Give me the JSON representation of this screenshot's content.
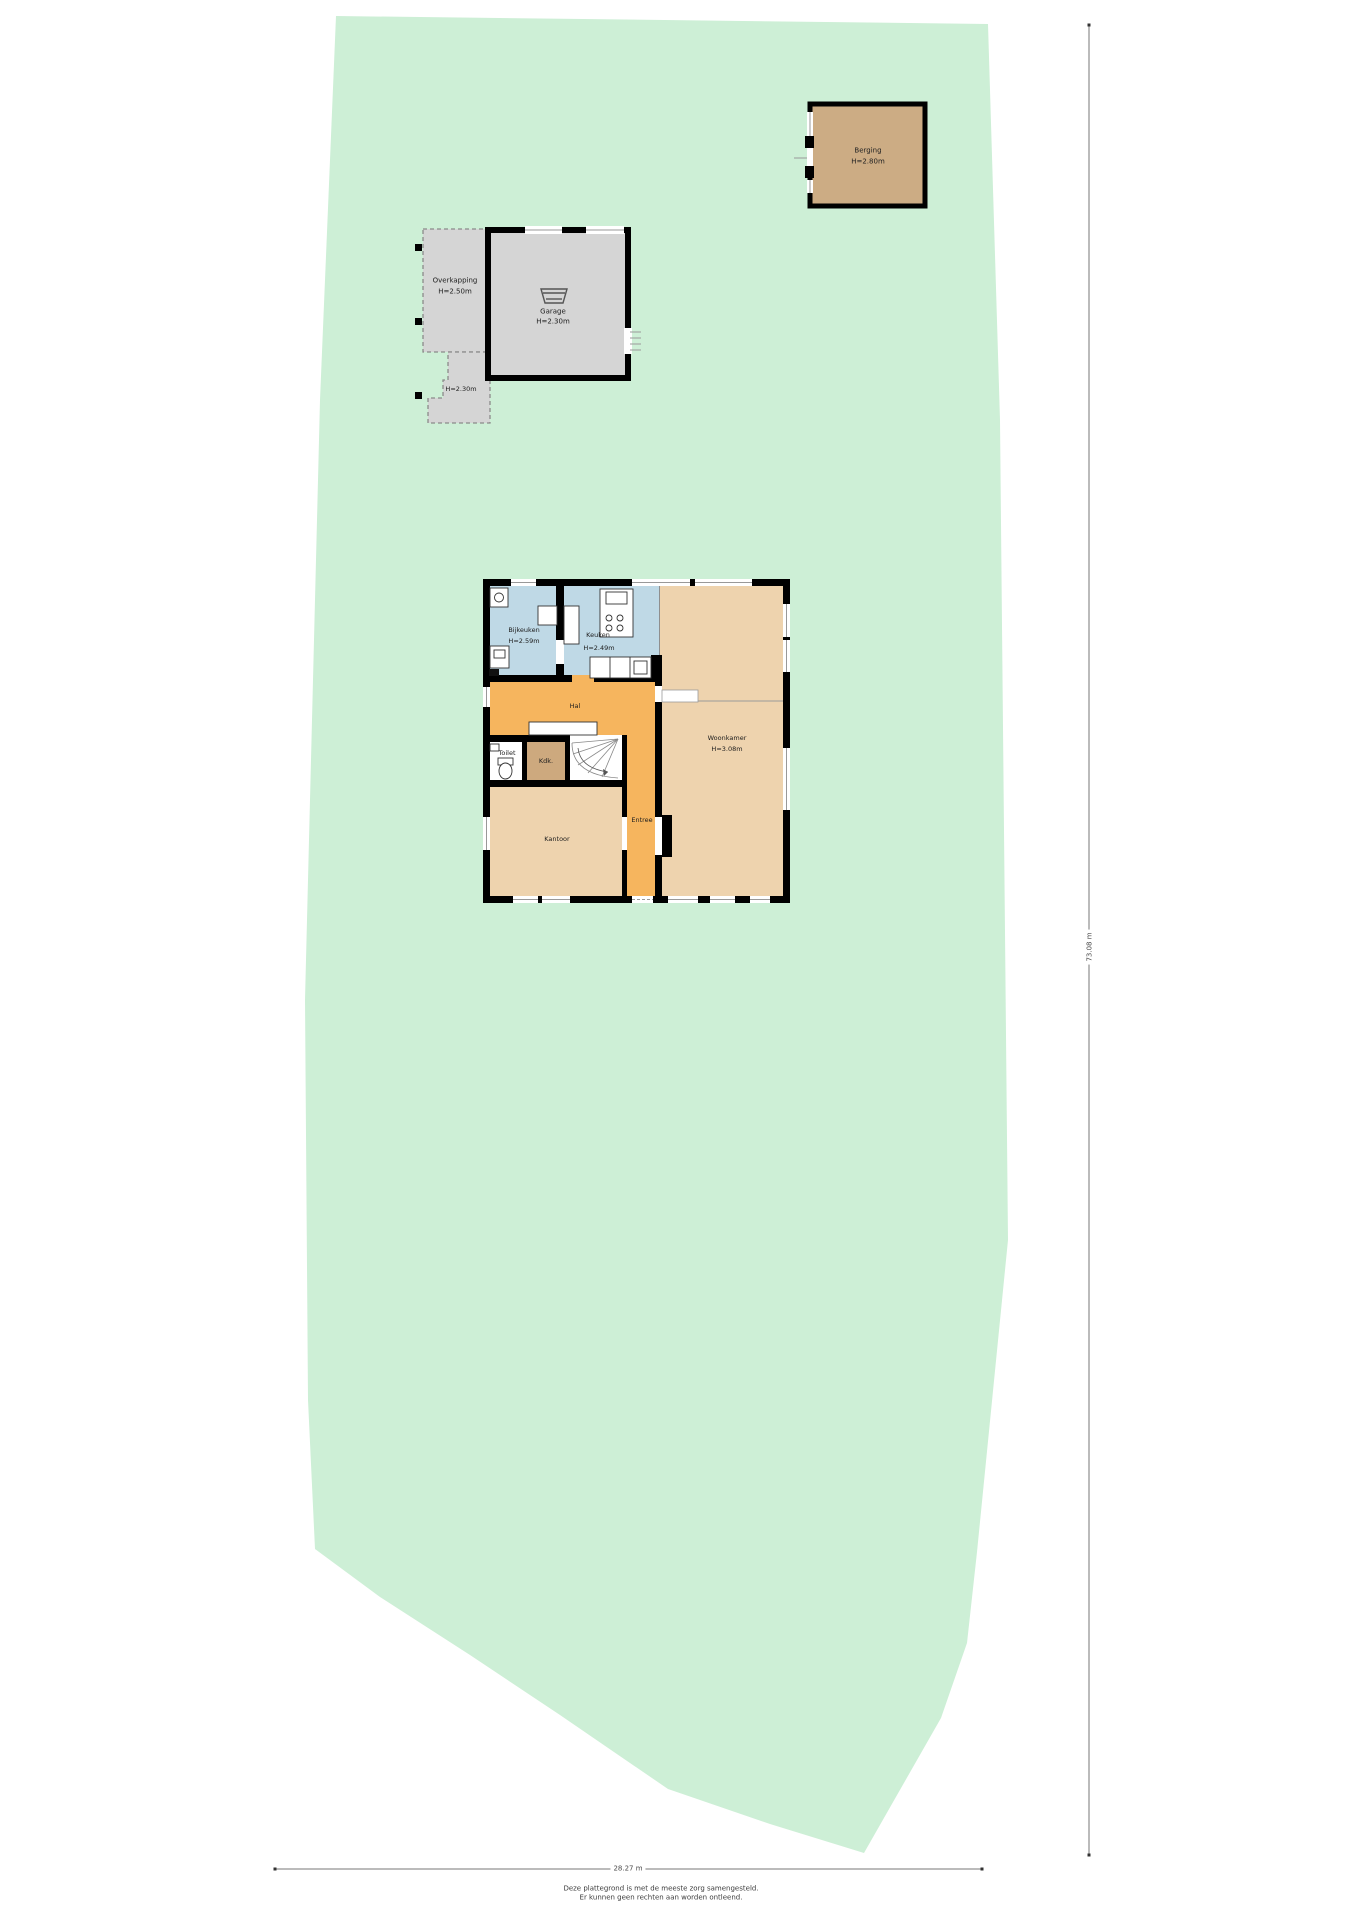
{
  "plot": {
    "type_label": "site-plan-floorplan",
    "ground_color": "#cdefd6",
    "width_label": "28.27 m",
    "height_label": "73.08 m"
  },
  "berging": {
    "name": "Berging",
    "height": "H=2.80m",
    "fill": "#ccac84"
  },
  "overkapping": {
    "name": "Overkapping",
    "height": "H=2.50m",
    "fill": "#d5d5d5"
  },
  "garage": {
    "name": "Garage",
    "height": "H=2.30m",
    "fill": "#d5d5d5"
  },
  "overkapping_klein": {
    "height": "H=2.30m"
  },
  "house": {
    "rooms": {
      "bijkeuken": {
        "name": "Bijkeuken",
        "height": "H=2.59m",
        "fill": "#bfd9e6"
      },
      "keuken": {
        "name": "Keuken",
        "height": "H=2.49m",
        "fill": "#bfd9e6"
      },
      "woonkamer": {
        "name": "Woonkamer",
        "height": "H=3.08m",
        "fill": "#eed3ae"
      },
      "hal": {
        "name": "Hal",
        "fill": "#f6b55e"
      },
      "entree": {
        "name": "Entree",
        "fill": "#f6b55e"
      },
      "toilet": {
        "name": "Toilet",
        "fill": "#ffffff"
      },
      "kast": {
        "name": "Kdk.",
        "fill": "#cda97e"
      },
      "kantoor": {
        "name": "Kantoor",
        "fill": "#eed3ae"
      }
    },
    "wall_color": "#000000"
  },
  "footer": {
    "line1": "Deze plattegrond is met de meeste zorg samengesteld.",
    "line2": "Er kunnen geen rechten aan worden ontleend."
  }
}
